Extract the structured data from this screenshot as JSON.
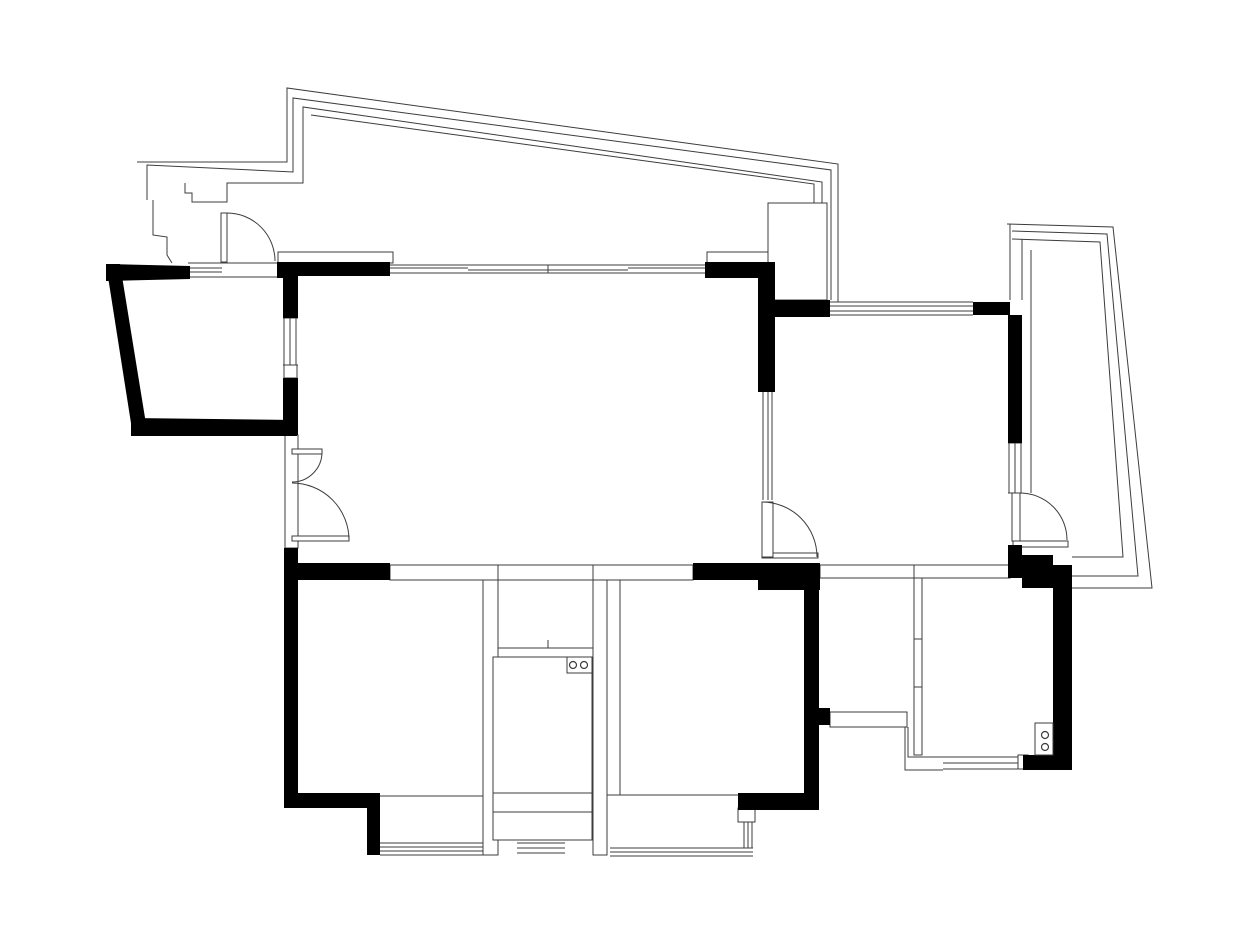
{
  "canvas": {
    "width": 1260,
    "height": 945,
    "background_color": "#ffffff",
    "wall_color": "#000000",
    "line_color": "#3c3c3c"
  },
  "floorplan": {
    "outline_rects": [
      {
        "name": "terrace-slab-left",
        "x": 278,
        "y": 252,
        "w": 115,
        "h": 11
      },
      {
        "name": "terrace-slab-right",
        "x": 707,
        "y": 252,
        "w": 68,
        "h": 11
      },
      {
        "name": "terrace-column",
        "x": 768,
        "y": 203,
        "w": 59,
        "h": 97
      },
      {
        "name": "living-left-sill-box",
        "x": 284,
        "y": 365,
        "w": 13,
        "h": 13
      },
      {
        "name": "living-left-thin-wall",
        "x": 285,
        "y": 435,
        "w": 13,
        "h": 113
      },
      {
        "name": "bedroom1-right-thin-wall",
        "x": 483,
        "y": 565,
        "w": 15,
        "h": 290
      },
      {
        "name": "duct-right-thin-wall",
        "x": 593,
        "y": 565,
        "w": 14,
        "h": 290
      },
      {
        "name": "bedroom2-left-thin-wall",
        "x": 607,
        "y": 565,
        "w": 13,
        "h": 230
      },
      {
        "name": "living-bottom-opening-left",
        "x": 390,
        "y": 565,
        "w": 108,
        "h": 15
      },
      {
        "name": "living-bottom-opening-right",
        "x": 593,
        "y": 565,
        "w": 100,
        "h": 15
      },
      {
        "name": "rightroom-bottom-thin-wall",
        "x": 820,
        "y": 565,
        "w": 190,
        "h": 13
      },
      {
        "name": "hallway-bottom-thin-wall",
        "x": 830,
        "y": 712,
        "w": 77,
        "h": 15
      },
      {
        "name": "bath-left-thin-wall",
        "x": 914,
        "y": 578,
        "w": 8,
        "h": 177
      },
      {
        "name": "duct-upper-box",
        "x": 498,
        "y": 580,
        "w": 95,
        "h": 68
      },
      {
        "name": "duct-lower-box",
        "x": 493,
        "y": 657,
        "w": 99,
        "h": 183
      },
      {
        "name": "bath-window-end-cap",
        "x": 1018,
        "y": 755,
        "w": 10,
        "h": 14
      },
      {
        "name": "bedroom2-window-end-cap",
        "x": 738,
        "y": 808,
        "w": 17,
        "h": 14
      },
      {
        "name": "door-threshold-rightroom",
        "x": 762,
        "y": 553,
        "w": 56,
        "h": 5
      },
      {
        "name": "door-threshold-balcony",
        "x": 1013,
        "y": 541,
        "w": 55,
        "h": 6
      }
    ],
    "polylines": [
      {
        "name": "terrace-outline-outer",
        "points": "137,162 287,162 287,88 838,164 838,302"
      },
      {
        "name": "terrace-outline-2",
        "points": "147,200 147,165 293,172 293,98 831,170 831,300"
      },
      {
        "name": "terrace-outline-3",
        "points": "185,183 185,193 192,193 192,202 227,202 227,183 303,183 303,107 822,182 822,203"
      },
      {
        "name": "terrace-outline-inner",
        "points": "311,115 814,184 814,203"
      },
      {
        "name": "terrace-step-left",
        "points": "153,200 153,235 167,237 167,255 172,263"
      },
      {
        "name": "balcony-outline-outer",
        "points": "1007,224 1113,227 1152,588 1072,588"
      },
      {
        "name": "balcony-left-edge",
        "points": "1010,224 1010,300"
      },
      {
        "name": "balcony-outline-2",
        "points": "1012,231 1107,234 1138,576 1072,576"
      },
      {
        "name": "balcony-outline-3",
        "points": "1012,239 1100,242 1123,557 1072,557"
      },
      {
        "name": "balcony-inner-edge",
        "points": "1022,239 1022,300"
      },
      {
        "name": "balcony-sill-line",
        "points": "1031,250 1031,493"
      },
      {
        "name": "hallway-step-outer",
        "points": "905,727 905,770 943,770"
      },
      {
        "name": "hallway-step-inner",
        "points": "908,727 908,757 943,757"
      }
    ],
    "lines": [
      {
        "name": "entry-window-line-1",
        "x1": 188,
        "y1": 263,
        "x2": 280,
        "y2": 263
      },
      {
        "name": "entry-window-line-2",
        "x1": 188,
        "y1": 277,
        "x2": 280,
        "y2": 277
      },
      {
        "name": "entry-window-line-3",
        "x1": 188,
        "y1": 268,
        "x2": 222,
        "y2": 268
      },
      {
        "name": "entry-window-line-4",
        "x1": 188,
        "y1": 272,
        "x2": 222,
        "y2": 272
      },
      {
        "name": "living-top-window-line-1",
        "x1": 390,
        "y1": 265,
        "x2": 705,
        "y2": 265
      },
      {
        "name": "living-top-window-line-2",
        "x1": 390,
        "y1": 273,
        "x2": 705,
        "y2": 273
      },
      {
        "name": "living-top-window-line-3",
        "x1": 390,
        "y1": 268,
        "x2": 468,
        "y2": 268
      },
      {
        "name": "living-top-window-line-4",
        "x1": 628,
        "y1": 268,
        "x2": 705,
        "y2": 268
      },
      {
        "name": "living-top-window-recess",
        "x1": 468,
        "y1": 270,
        "x2": 628,
        "y2": 270
      },
      {
        "name": "living-top-window-tick",
        "x1": 548,
        "y1": 265,
        "x2": 548,
        "y2": 273
      },
      {
        "name": "living-left-window-line-1",
        "x1": 284,
        "y1": 318,
        "x2": 284,
        "y2": 365
      },
      {
        "name": "living-left-window-line-2",
        "x1": 290,
        "y1": 318,
        "x2": 290,
        "y2": 365
      },
      {
        "name": "living-left-window-line-3",
        "x1": 296,
        "y1": 318,
        "x2": 296,
        "y2": 365
      },
      {
        "name": "living-left-window-cap-1",
        "x1": 283,
        "y1": 318,
        "x2": 298,
        "y2": 318
      },
      {
        "name": "living-left-window-cap-2",
        "x1": 283,
        "y1": 365,
        "x2": 298,
        "y2": 365
      },
      {
        "name": "rightroom-top-window-line-1",
        "x1": 830,
        "y1": 302,
        "x2": 973,
        "y2": 302
      },
      {
        "name": "rightroom-top-window-line-2",
        "x1": 830,
        "y1": 306,
        "x2": 973,
        "y2": 306
      },
      {
        "name": "rightroom-top-window-line-3",
        "x1": 830,
        "y1": 311,
        "x2": 973,
        "y2": 311
      },
      {
        "name": "rightroom-top-window-line-4",
        "x1": 830,
        "y1": 315,
        "x2": 973,
        "y2": 315
      },
      {
        "name": "rightroom-side-window-line-1",
        "x1": 1009,
        "y1": 443,
        "x2": 1009,
        "y2": 493
      },
      {
        "name": "rightroom-side-window-line-2",
        "x1": 1015,
        "y1": 443,
        "x2": 1015,
        "y2": 493
      },
      {
        "name": "rightroom-side-window-line-3",
        "x1": 1021,
        "y1": 443,
        "x2": 1021,
        "y2": 493
      },
      {
        "name": "rightroom-side-window-cap-1",
        "x1": 1008,
        "y1": 443,
        "x2": 1022,
        "y2": 443
      },
      {
        "name": "rightroom-side-window-cap-2",
        "x1": 1008,
        "y1": 493,
        "x2": 1022,
        "y2": 493
      },
      {
        "name": "partition-window-line-1",
        "x1": 763,
        "y1": 392,
        "x2": 763,
        "y2": 500
      },
      {
        "name": "partition-window-line-2",
        "x1": 768,
        "y1": 392,
        "x2": 768,
        "y2": 500
      },
      {
        "name": "partition-window-line-3",
        "x1": 772,
        "y1": 392,
        "x2": 772,
        "y2": 500
      },
      {
        "name": "bath-window-line-1",
        "x1": 943,
        "y1": 757,
        "x2": 1018,
        "y2": 757
      },
      {
        "name": "bath-window-line-2",
        "x1": 943,
        "y1": 763,
        "x2": 1018,
        "y2": 763
      },
      {
        "name": "bath-window-line-3",
        "x1": 943,
        "y1": 769,
        "x2": 1018,
        "y2": 769
      },
      {
        "name": "bedroom2-bay-window-line-1",
        "x1": 610,
        "y1": 848,
        "x2": 753,
        "y2": 848
      },
      {
        "name": "bedroom2-bay-window-line-2",
        "x1": 610,
        "y1": 852,
        "x2": 753,
        "y2": 852
      },
      {
        "name": "bedroom2-bay-window-line-3",
        "x1": 610,
        "y1": 856,
        "x2": 753,
        "y2": 856
      },
      {
        "name": "bedroom2-bay-window-side-1",
        "x1": 744,
        "y1": 822,
        "x2": 744,
        "y2": 848
      },
      {
        "name": "bedroom2-bay-window-side-2",
        "x1": 748,
        "y1": 822,
        "x2": 748,
        "y2": 848
      },
      {
        "name": "bedroom2-bay-window-side-3",
        "x1": 752,
        "y1": 822,
        "x2": 752,
        "y2": 848
      },
      {
        "name": "bedroom1-bay-window-line-1",
        "x1": 380,
        "y1": 843,
        "x2": 483,
        "y2": 843
      },
      {
        "name": "bedroom1-bay-window-line-2",
        "x1": 380,
        "y1": 847,
        "x2": 483,
        "y2": 847
      },
      {
        "name": "bedroom1-bay-window-line-3",
        "x1": 380,
        "y1": 851,
        "x2": 483,
        "y2": 851
      },
      {
        "name": "bedroom1-bay-window-line-4",
        "x1": 380,
        "y1": 855,
        "x2": 483,
        "y2": 855
      },
      {
        "name": "duct-bay-window-line-1",
        "x1": 517,
        "y1": 843,
        "x2": 565,
        "y2": 843
      },
      {
        "name": "duct-bay-window-line-2",
        "x1": 517,
        "y1": 848,
        "x2": 565,
        "y2": 848
      },
      {
        "name": "duct-bay-window-line-3",
        "x1": 517,
        "y1": 853,
        "x2": 565,
        "y2": 853
      },
      {
        "name": "duct-top-face-line",
        "x1": 498,
        "y1": 565,
        "x2": 593,
        "y2": 565
      },
      {
        "name": "bedroom1-bay-sill",
        "x1": 380,
        "y1": 796,
        "x2": 483,
        "y2": 796
      },
      {
        "name": "bedroom2-bay-sill",
        "x1": 620,
        "y1": 795,
        "x2": 738,
        "y2": 795
      },
      {
        "name": "duct-band-line-1",
        "x1": 493,
        "y1": 793,
        "x2": 592,
        "y2": 793
      },
      {
        "name": "duct-band-line-2",
        "x1": 493,
        "y1": 812,
        "x2": 592,
        "y2": 812
      },
      {
        "name": "duct-box-tick",
        "x1": 548,
        "y1": 640,
        "x2": 548,
        "y2": 648
      },
      {
        "name": "bath-wall-tick-1",
        "x1": 914,
        "y1": 639,
        "x2": 922,
        "y2": 639
      },
      {
        "name": "bath-wall-tick-2",
        "x1": 914,
        "y1": 687,
        "x2": 922,
        "y2": 687
      },
      {
        "name": "rightroom-bottom-wall-tick",
        "x1": 914,
        "y1": 565,
        "x2": 914,
        "y2": 578
      }
    ],
    "black_walls": [
      {
        "name": "entry-top-wall",
        "points": "106,264 190,266 190,279 106,281"
      },
      {
        "name": "entry-top-wall-post",
        "points": "277,262 298,262 298,278 277,278"
      },
      {
        "name": "entry-left-wall",
        "points": "106,264 120,264 147,430 133,436"
      },
      {
        "name": "entry-bottom-wall",
        "points": "131,418 297,420 297,436 131,436"
      },
      {
        "name": "living-left-wall-upper",
        "points": "283,262 298,262 298,318 283,318"
      },
      {
        "name": "living-left-wall-mid",
        "points": "283,378 298,378 298,435 283,435"
      },
      {
        "name": "living-top-wall-left",
        "points": "283,262 390,262 390,276 283,276"
      },
      {
        "name": "living-top-wall-right",
        "points": "705,262 775,262 775,278 705,278"
      },
      {
        "name": "partition-wall-upper",
        "points": "758,262 775,262 775,392 758,392"
      },
      {
        "name": "rightroom-top-wall-left",
        "points": "773,300 830,300 830,317 773,317"
      },
      {
        "name": "rightroom-top-wall-right",
        "points": "973,302 1010,302 1010,315 973,315"
      },
      {
        "name": "rightroom-right-wall-upper",
        "points": "1008,315 1022,315 1022,443 1008,443"
      },
      {
        "name": "rightroom-right-wall-lower",
        "points": "1008,545 1022,545 1022,578 1008,578"
      },
      {
        "name": "rightroom-bottom-right-post",
        "points": "1010,555 1053,555 1053,578 1010,578"
      },
      {
        "name": "balcony-bottom-wall",
        "points": "1022,565 1072,565 1072,588 1022,588"
      },
      {
        "name": "bath-right-wall",
        "points": "1053,578 1072,578 1072,770 1053,770"
      },
      {
        "name": "bath-bottom-wall",
        "points": "1023,755 1053,755 1053,770 1023,770"
      },
      {
        "name": "living-bottom-wall-left",
        "points": "285,563 390,563 390,580 285,580"
      },
      {
        "name": "living-bottom-wall-right",
        "points": "693,563 820,563 820,580 693,580"
      },
      {
        "name": "living-bottom-corner",
        "points": "758,563 820,563 820,590 758,590"
      },
      {
        "name": "bedroom2-right-wall",
        "points": "804,580 819,580 819,810 804,810"
      },
      {
        "name": "bedroom2-bottom-wall",
        "points": "738,793 819,793 819,810 738,810"
      },
      {
        "name": "hallway-wall-stub",
        "points": "819,708 830,708 830,725 819,725"
      },
      {
        "name": "bedroom1-left-wall",
        "points": "284,548 298,548 298,808 284,808"
      },
      {
        "name": "bedroom1-bottom-wall",
        "points": "298,793 380,793 380,808 298,808"
      },
      {
        "name": "bedroom1-bay-step",
        "points": "367,795 380,795 380,855 367,855"
      }
    ],
    "doors": [
      {
        "name": "entry-door",
        "leaf": {
          "x": 221,
          "y": 213,
          "w": 6,
          "h": 49
        },
        "arc": "M227,213 A48 48 0 0 1 275,261"
      },
      {
        "name": "living-closet-door",
        "leaf": {
          "x": 292,
          "y": 449,
          "w": 30,
          "h": 5
        },
        "arc": "M322,452 A30 30 0 0 1 292,482"
      },
      {
        "name": "living-side-door",
        "leaf": {
          "x": 292,
          "y": 536,
          "w": 57,
          "h": 5
        },
        "arc": "M292,483 A57 57 0 0 1 349,540"
      },
      {
        "name": "rightroom-door",
        "leaf": {
          "x": 762,
          "y": 502,
          "w": 11,
          "h": 55
        },
        "arc": "M762,502 A55 55 0 0 1 817,557"
      },
      {
        "name": "balcony-door",
        "leaf": {
          "x": 1012,
          "y": 493,
          "w": 8,
          "h": 48
        },
        "arc": "M1020,493 A47 47 0 0 1 1067,540"
      }
    ],
    "fixtures": [
      {
        "name": "kitchen-stove",
        "rect": {
          "x": 567,
          "y": 657,
          "w": 25,
          "h": 16
        },
        "circles": [
          {
            "cx": 573,
            "cy": 665,
            "r": 3.5
          },
          {
            "cx": 584,
            "cy": 665,
            "r": 3.5
          }
        ]
      },
      {
        "name": "bath-unit",
        "rect": {
          "x": 1035,
          "y": 723,
          "w": 18,
          "h": 32
        },
        "circles": [
          {
            "cx": 1045,
            "cy": 735,
            "r": 3.5
          },
          {
            "cx": 1045,
            "cy": 747,
            "r": 3.5
          }
        ]
      }
    ]
  }
}
